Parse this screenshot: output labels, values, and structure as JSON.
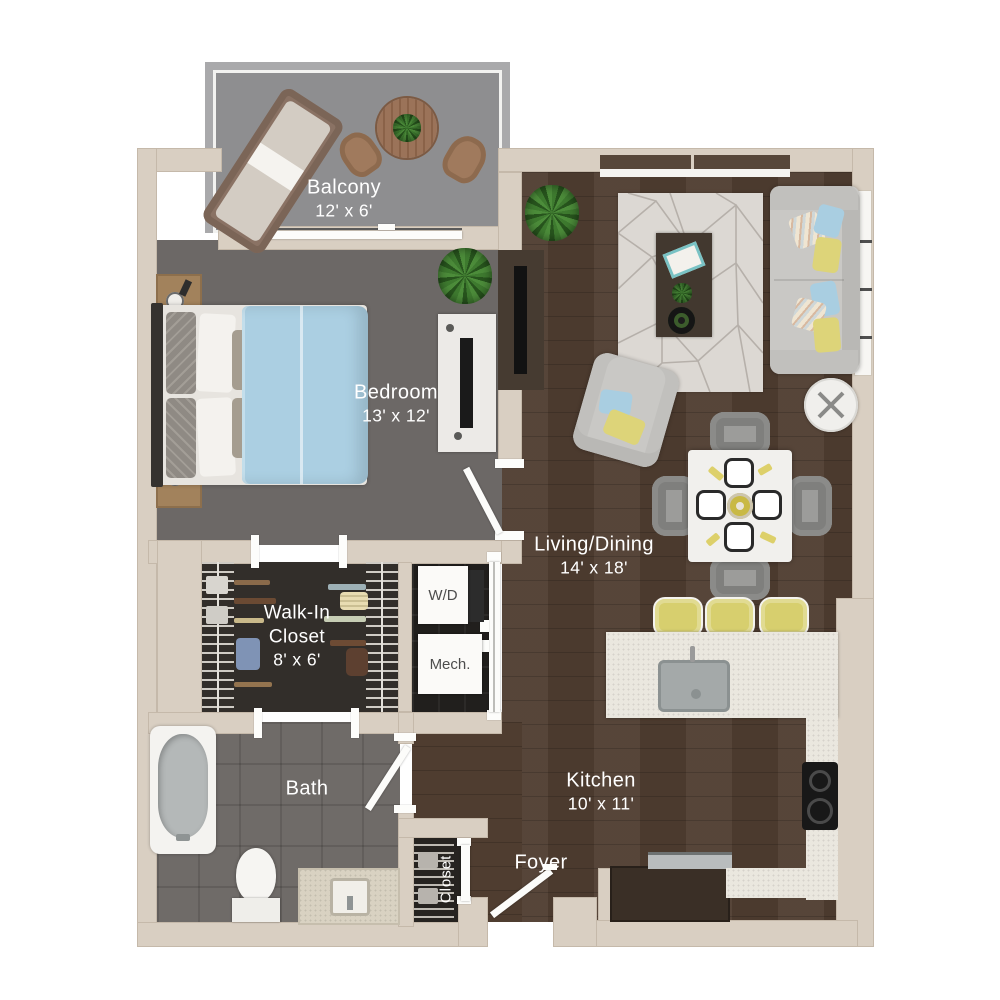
{
  "plan_title": "One-bedroom apartment floor plan",
  "rooms": {
    "balcony": {
      "name": "Balcony",
      "dims": "12' x 6'"
    },
    "bedroom": {
      "name": "Bedroom",
      "dims": "13' x 12'"
    },
    "walk_in_closet": {
      "name_line1": "Walk-In",
      "name_line2": "Closet",
      "dims": "8' x 6'"
    },
    "living_dining": {
      "name": "Living/Dining",
      "dims": "14' x 18'"
    },
    "kitchen": {
      "name": "Kitchen",
      "dims": "10' x 11'"
    },
    "bath": {
      "name": "Bath"
    },
    "foyer": {
      "name": "Foyer"
    },
    "entry_closet": {
      "name": "Closet"
    },
    "laundry": {
      "name": "W/D"
    },
    "mechanical": {
      "name": "Mech."
    }
  },
  "colors": {
    "wall": "#d9cfc2",
    "wood_floor": "#4f3d30",
    "bedroom_floor": "#6c6866",
    "balcony_floor": "#8e8e90",
    "closet_floor": "#2f2c29",
    "bath_floor": "#6f6b68",
    "counter_white": "#eae7df",
    "accent_yellow": "#d8d06c",
    "accent_blue": "#a9cee1",
    "sofa_gray": "#c8c7c4",
    "label_text": "#ffffff"
  }
}
